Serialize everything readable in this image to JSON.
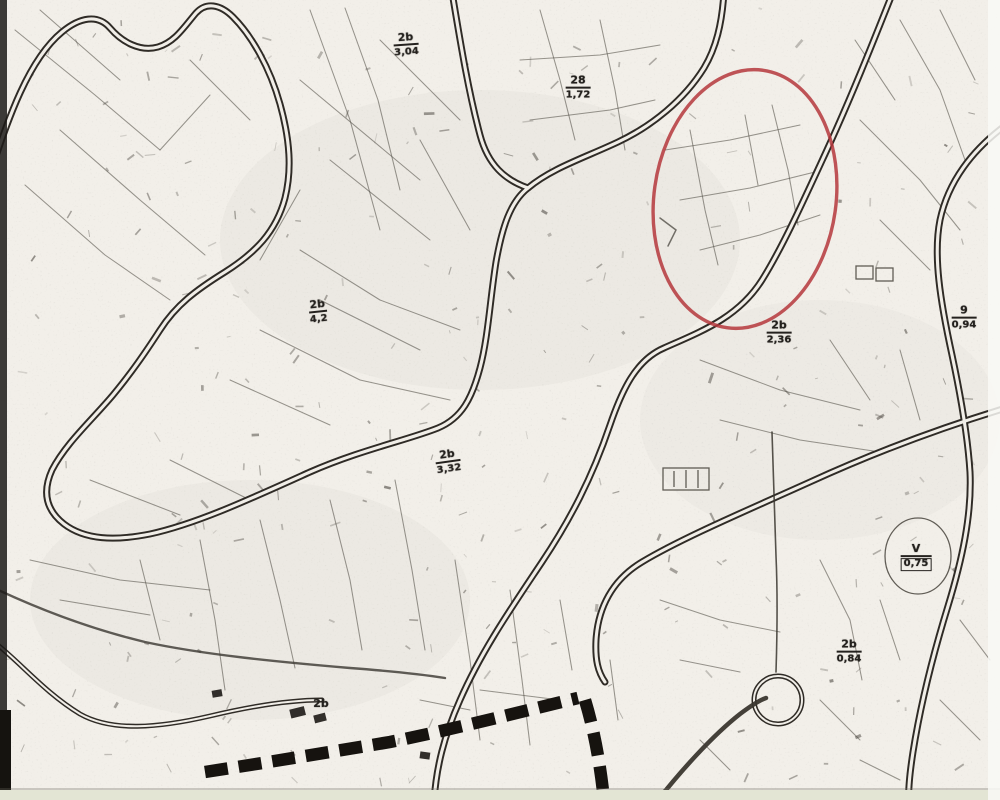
{
  "map": {
    "background": "#f2efe9",
    "ink": "#2f2b26",
    "parcel_line_color": "#57534b",
    "boundary_dash_color": "#16130f",
    "annotation_color": "#b5373c",
    "margin_strip_color": "#e3e5d4"
  },
  "annotation": {
    "shape": "ellipse",
    "cx": 745,
    "cy": 199,
    "rx": 91,
    "ry": 130,
    "rotation_deg": 8
  },
  "labels": [
    {
      "id": "2b-304",
      "num": "2b",
      "den": "3,04",
      "x": 406,
      "y": 45,
      "rot": -4
    },
    {
      "id": "28-172",
      "num": "28",
      "den": "1,72",
      "x": 578,
      "y": 88,
      "rot": 0
    },
    {
      "id": "2b-42",
      "num": "2b",
      "den": "4,2",
      "x": 318,
      "y": 312,
      "rot": -6
    },
    {
      "id": "2b-236",
      "num": "2b",
      "den": "2,36",
      "x": 779,
      "y": 333,
      "rot": 0
    },
    {
      "id": "9-094",
      "num": "9",
      "den": "0,94",
      "x": 964,
      "y": 318,
      "rot": 0
    },
    {
      "id": "2b-332",
      "num": "2b",
      "den": "3,32",
      "x": 448,
      "y": 462,
      "rot": -8
    },
    {
      "id": "2b-084",
      "num": "2b",
      "den": "0,84",
      "x": 849,
      "y": 652,
      "rot": 0
    },
    {
      "id": "v-075",
      "num": "V",
      "den": "0,75",
      "x": 916,
      "y": 557,
      "rot": 0,
      "boxed": true
    },
    {
      "id": "2b-small",
      "num": "2b",
      "den": "",
      "x": 321,
      "y": 704,
      "rot": 0
    }
  ]
}
